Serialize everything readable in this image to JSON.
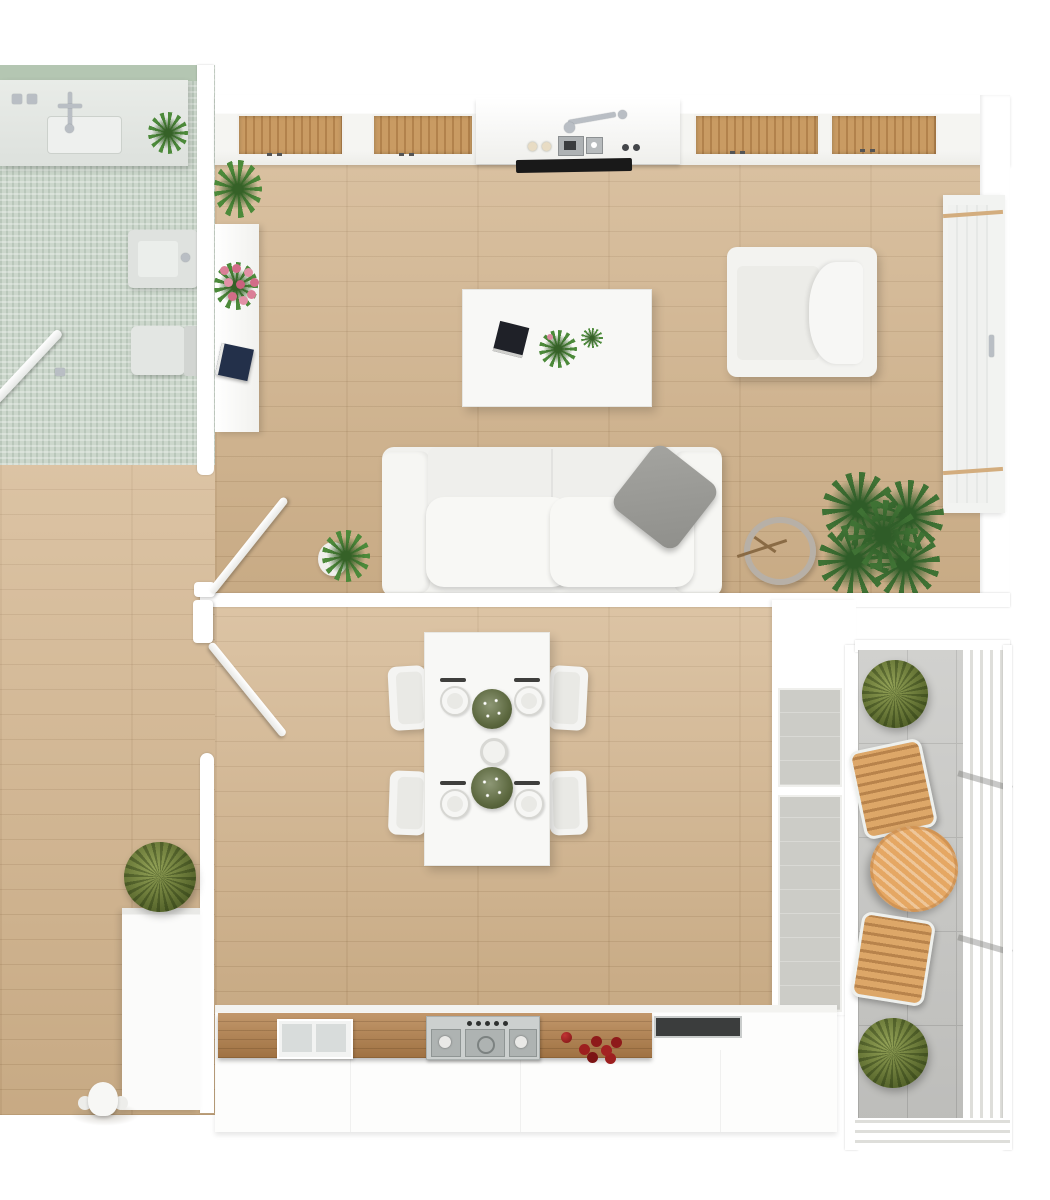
{
  "scene": {
    "type": "3d-apartment-floor-plan-top-view",
    "rooms": [
      {
        "name": "bathroom",
        "floor": "mint mosaic tile",
        "items": [
          "vanity counter with sink and faucets",
          "potted plant on vanity",
          "bidet",
          "toilet",
          "open glass shower door"
        ]
      },
      {
        "name": "living-room",
        "floor": "light oak planks",
        "items": [
          "kitchenette counter with wood slat panels, sink, faucet, cooktop and black vent",
          "console table with plant, pink roses and books",
          "white coffee table with book, flowers and plant",
          "white armchair",
          "white two-seat sofa with gray cushion",
          "small potted plant",
          "decorative metal ring sculpture",
          "palm plant",
          "tall window with wooden rails"
        ]
      },
      {
        "name": "dining-room",
        "floor": "light oak planks",
        "items": [
          "white dining table",
          "four white chairs",
          "four place settings",
          "two green centerpieces",
          "serving bowl",
          "glass door to balcony"
        ]
      },
      {
        "name": "kitchen",
        "floor": "light oak planks",
        "items": [
          "wooden countertop",
          "inset double sink",
          "stainless stove with knobs",
          "red fruit",
          "dark cooktop",
          "white cabinet fronts"
        ]
      },
      {
        "name": "hallway",
        "floor": "light oak planks",
        "items": [
          "open double doors",
          "tall white cabinet",
          "potted plant",
          "entry fixture"
        ]
      },
      {
        "name": "balcony",
        "floor": "gray stone tile",
        "items": [
          "round wooden table",
          "two wooden deck chairs",
          "two green shrubs",
          "white slat railing"
        ]
      }
    ]
  },
  "labels": {
    "plan": "3D apartment floor plan, top-down view",
    "bathroom": "Bathroom",
    "vanity": "Vanity counter with sink",
    "vanity_plant": "Potted plant",
    "bidet": "Bidet",
    "toilet": "Toilet",
    "shower_door": "Open glass shower door",
    "console": "Console table",
    "console_plant": "Potted plant",
    "console_flowers": "Pink roses",
    "console_books": "Books",
    "kitchenette": "Kitchenette counter",
    "kitchenette_sink": "Sink with faucet",
    "kitchenette_vent": "Cooktop vent",
    "window": "Tall window",
    "coffee_table": "Coffee table",
    "coffee_book": "Book",
    "coffee_flowers": "Flowering plant",
    "armchair": "Armchair",
    "sofa": "Two-seat sofa",
    "sofa_pillow": "Gray cushion",
    "floor_plant": "Potted plant",
    "ring": "Decorative ring sculpture",
    "palm": "Palm plant",
    "divider_wall": "Partition wall",
    "door_upper": "Open door to living room",
    "door_lower": "Open door to dining room",
    "dining_table": "Dining table",
    "dining_chair": "Dining chair",
    "place_setting": "Place setting",
    "centerpiece": "Centerpiece plant",
    "bowl": "Serving bowl",
    "glass_door": "Glass door to balcony",
    "counter": "Kitchen counter",
    "kitchen_sink": "Kitchen sink",
    "stove": "Stove",
    "fruits": "Red fruit",
    "cooktop": "Cooktop",
    "cabinet": "Tall cabinet",
    "hall_plant": "Potted plant",
    "entry_fixture": "Entry fixture",
    "balcony": "Balcony",
    "balcony_table": "Round wooden table",
    "balcony_chair_top": "Wooden deck chair",
    "balcony_chair_bottom": "Wooden deck chair",
    "shrub_top": "Green shrub",
    "shrub_bottom": "Green shrub",
    "railing": "Balcony railing"
  },
  "palette": {
    "background": "#ffffff",
    "floor_wood": "#d2b38b",
    "bathroom_tile": "#ccd7cc",
    "bathroom_wall_tile": "#b4c6b2",
    "counter_wood": "#b5814b",
    "balcony_tile": "#c9c9c6",
    "plant_green": "#6d7c3b",
    "palm_green": "#3f7234",
    "sofa_white": "#f2f2ef",
    "pillow_gray": "#9b9b97",
    "balcony_table_wood": "#e5a763",
    "fruit_red": "#9d1f1f",
    "flower_pink": "#db7f97",
    "vent_black": "#1a1a1a"
  }
}
